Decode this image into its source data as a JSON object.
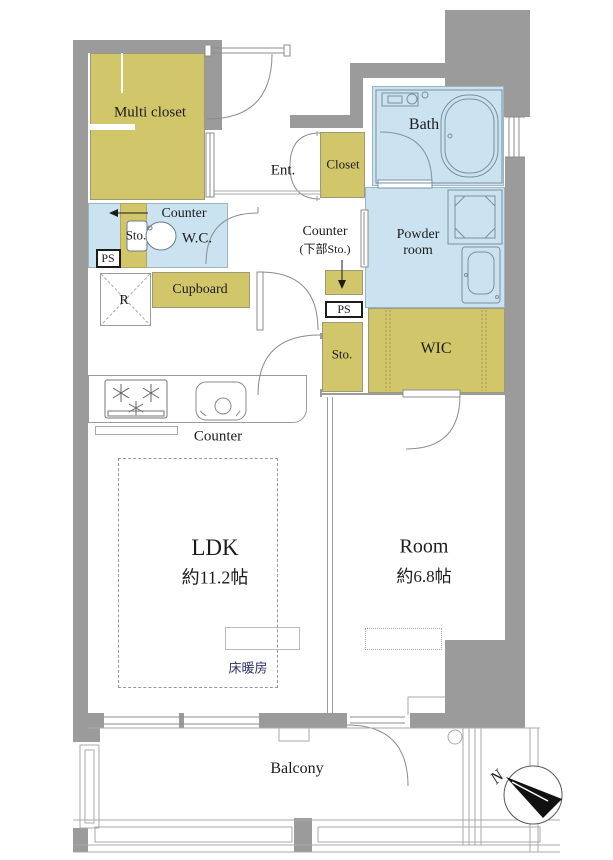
{
  "plan_title": "apartment-floor-plan",
  "colors": {
    "wall_gray": "#9b9b9b",
    "storage_yellow": "#d2c66a",
    "wet_area_blue": "#cbe3f0",
    "floor_heating_navy": "#2e3270",
    "text_black": "#1c1c1c"
  },
  "labels": {
    "multi_closet": "Multi closet",
    "entrance": "Ent.",
    "closet": "Closet",
    "bath": "Bath",
    "wc_counter": "Counter",
    "wc_storage": "Sto.",
    "wc": "W.C.",
    "ps_left": "PS",
    "cupboard": "Cupboard",
    "refrigerator": "R",
    "hall_counter_line1": "Counter",
    "hall_counter_line2": "(下部Sto.)",
    "powder_room": "Powder room",
    "ps_right": "PS",
    "hall_storage": "Sto.",
    "wic": "WIC",
    "kitchen_counter": "Counter",
    "ldk_name": "LDK",
    "ldk_size": "約11.2帖",
    "room_name": "Room",
    "room_size": "約6.8帖",
    "floor_heating": "床暖房",
    "balcony": "Balcony",
    "compass_north": "N"
  }
}
